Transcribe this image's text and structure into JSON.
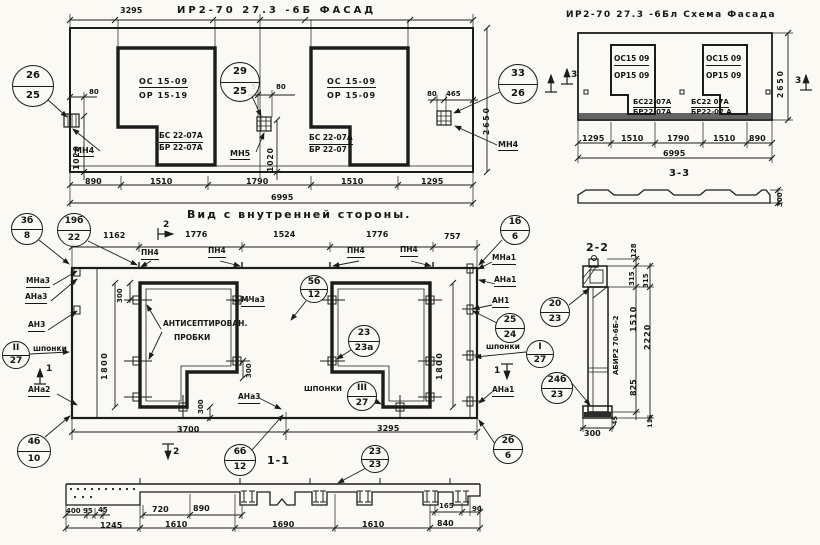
{
  "colors": {
    "ink": "#1c1c1c",
    "paper": "#faf9f4"
  },
  "labels": [
    {
      "name": "facade-title",
      "text": "ИР2-70 27.3 -6Б  ФАСАД",
      "x": 177,
      "y": 5,
      "fs": 10,
      "ls": 3
    },
    {
      "name": "schema-title",
      "text": "ИР2-70 27.3 -6Бл  Схема Фасада",
      "x": 566,
      "y": 10,
      "fs": 9,
      "ls": 1.5
    },
    {
      "name": "inner-view-title",
      "text": "Вид с внутренней стороны.",
      "x": 187,
      "y": 209,
      "fs": 11,
      "ls": 2
    },
    {
      "name": "section-1-1-title",
      "text": "1-1",
      "x": 267,
      "y": 455,
      "fs": 11,
      "ls": 1
    },
    {
      "name": "section-2-2-title",
      "text": "2-2",
      "x": 586,
      "y": 242,
      "fs": 11,
      "ls": 1
    },
    {
      "name": "section-3-3-title",
      "text": "3-3",
      "x": 669,
      "y": 168,
      "fs": 10,
      "ls": 1
    },
    {
      "name": "facade-dim-3295",
      "text": "3295",
      "x": 120,
      "y": 6
    },
    {
      "name": "facade-dim-890",
      "text": "890",
      "x": 85,
      "y": 177
    },
    {
      "name": "facade-dim-1510-a",
      "text": "1510",
      "x": 150,
      "y": 177
    },
    {
      "name": "facade-dim-1790",
      "text": "1790",
      "x": 246,
      "y": 177
    },
    {
      "name": "facade-dim-1510-b",
      "text": "1510",
      "x": 341,
      "y": 177
    },
    {
      "name": "facade-dim-1295",
      "text": "1295",
      "x": 421,
      "y": 177
    },
    {
      "name": "facade-dim-6995",
      "text": "6995",
      "x": 271,
      "y": 193
    },
    {
      "name": "facade-dim-80-left",
      "text": "80",
      "x": 89,
      "y": 88,
      "fs": 7
    },
    {
      "name": "facade-dim-1020-left",
      "text": "1020",
      "x": 73,
      "y": 170,
      "rot": -90,
      "fs": 7.5,
      "ls": 1
    },
    {
      "name": "facade-anchor-mn4-left",
      "text": "МН4",
      "x": 74,
      "y": 146,
      "u": 1
    },
    {
      "name": "facade-dim-5",
      "text": "5",
      "x": 251,
      "y": 83,
      "fs": 7
    },
    {
      "name": "facade-dim-80-mid",
      "text": "80",
      "x": 276,
      "y": 83,
      "fs": 7
    },
    {
      "name": "facade-dim-1020-mid",
      "text": "1020",
      "x": 267,
      "y": 172,
      "rot": -90,
      "fs": 7.5,
      "ls": 1
    },
    {
      "name": "facade-anchor-mn5",
      "text": "МН5",
      "x": 230,
      "y": 149,
      "u": 1
    },
    {
      "name": "facade-dim-80-right",
      "text": "80",
      "x": 427,
      "y": 90,
      "fs": 7
    },
    {
      "name": "facade-dim-465",
      "text": "465",
      "x": 446,
      "y": 90,
      "fs": 7
    },
    {
      "name": "facade-dim-2650",
      "text": "2650",
      "x": 483,
      "y": 135,
      "rot": -90,
      "fs": 7.5,
      "ls": 2
    },
    {
      "name": "facade-anchor-mn4-right",
      "text": "МН4",
      "x": 498,
      "y": 140,
      "u": 1
    },
    {
      "name": "facade-win1-block-os",
      "text": "ОС 15-09",
      "x": 139,
      "y": 77,
      "u": 1,
      "ls": 1
    },
    {
      "name": "facade-win1-block-or",
      "text": "ОР 15-19",
      "x": 139,
      "y": 91,
      "ls": 1
    },
    {
      "name": "facade-win1-block-bs",
      "text": "БС 22-07А",
      "x": 159,
      "y": 132,
      "u": 1,
      "fs": 7.5
    },
    {
      "name": "facade-win1-block-br",
      "text": "БР 22-07А",
      "x": 159,
      "y": 144,
      "fs": 7.5
    },
    {
      "name": "facade-win2-block-os",
      "text": "ОС 15-09",
      "x": 327,
      "y": 77,
      "u": 1,
      "ls": 1
    },
    {
      "name": "facade-win2-block-or",
      "text": "ОР 15-09",
      "x": 327,
      "y": 91,
      "ls": 1
    },
    {
      "name": "facade-win2-block-bs",
      "text": "БС 22-07А",
      "x": 309,
      "y": 134,
      "u": 1,
      "fs": 7.5
    },
    {
      "name": "facade-win2-block-br",
      "text": "БР 22-07",
      "x": 309,
      "y": 146,
      "fs": 7.5
    },
    {
      "name": "schema-win1-block-os",
      "text": "ОС15 09",
      "x": 614,
      "y": 55,
      "u": 1,
      "fs": 7.5
    },
    {
      "name": "schema-win1-block-or",
      "text": "ОР15 09",
      "x": 614,
      "y": 72,
      "fs": 7.5
    },
    {
      "name": "schema-win1-block-bs",
      "text": "БС22-07А",
      "x": 633,
      "y": 98,
      "u": 1,
      "fs": 7
    },
    {
      "name": "schema-win1-block-br",
      "text": "БР22-07А",
      "x": 633,
      "y": 108,
      "fs": 7
    },
    {
      "name": "schema-win2-block-os",
      "text": "ОС15 09",
      "x": 706,
      "y": 55,
      "u": 1,
      "fs": 7.5
    },
    {
      "name": "schema-win2-block-or",
      "text": "ОР15 09",
      "x": 706,
      "y": 72,
      "fs": 7.5
    },
    {
      "name": "schema-win2-block-bs",
      "text": "БС22 07А",
      "x": 691,
      "y": 98,
      "u": 1,
      "fs": 7
    },
    {
      "name": "schema-win2-block-br",
      "text": "БР22-07 А",
      "x": 691,
      "y": 108,
      "fs": 7
    },
    {
      "name": "schema-dim-1295",
      "text": "1295",
      "x": 582,
      "y": 134
    },
    {
      "name": "schema-dim-1510-a",
      "text": "1510",
      "x": 621,
      "y": 134
    },
    {
      "name": "schema-dim-1790",
      "text": "1790",
      "x": 667,
      "y": 134
    },
    {
      "name": "schema-dim-1510-b",
      "text": "1510",
      "x": 713,
      "y": 134
    },
    {
      "name": "schema-dim-890",
      "text": "890",
      "x": 749,
      "y": 134
    },
    {
      "name": "schema-dim-6995",
      "text": "6995",
      "x": 663,
      "y": 149
    },
    {
      "name": "schema-dim-2650",
      "text": "2650",
      "x": 777,
      "y": 98,
      "rot": -90,
      "fs": 7.5,
      "ls": 2
    },
    {
      "name": "schema-section3-left",
      "text": "3",
      "x": 571,
      "y": 70,
      "fs": 9
    },
    {
      "name": "schema-section3-right",
      "text": "3",
      "x": 795,
      "y": 76,
      "fs": 9
    },
    {
      "name": "section33-dim-300",
      "text": "300",
      "x": 776,
      "y": 207,
      "rot": -90,
      "fs": 7
    },
    {
      "name": "inner-dim-1162",
      "text": "1162",
      "x": 103,
      "y": 231
    },
    {
      "name": "inner-dim-1776-a",
      "text": "1776",
      "x": 185,
      "y": 230
    },
    {
      "name": "inner-dim-1524",
      "text": "1524",
      "x": 273,
      "y": 230
    },
    {
      "name": "inner-dim-1776-b",
      "text": "1776",
      "x": 366,
      "y": 230
    },
    {
      "name": "inner-dim-757",
      "text": "757",
      "x": 444,
      "y": 232
    },
    {
      "name": "inner-section2-top",
      "text": "2",
      "x": 163,
      "y": 220,
      "fs": 9
    },
    {
      "name": "inner-pn4-1",
      "text": "ПН4",
      "x": 141,
      "y": 249,
      "u": 1,
      "fs": 7.5
    },
    {
      "name": "inner-pn4-2",
      "text": "ПН4",
      "x": 208,
      "y": 247,
      "u": 1,
      "fs": 7.5
    },
    {
      "name": "inner-pn4-3",
      "text": "ПН4",
      "x": 347,
      "y": 247,
      "u": 1,
      "fs": 7.5
    },
    {
      "name": "inner-pn4-4",
      "text": "ПН4",
      "x": 400,
      "y": 246,
      "u": 1,
      "fs": 7.5
    },
    {
      "name": "inner-anchor-mna3",
      "text": "МНа3",
      "x": 26,
      "y": 277,
      "u": 1,
      "fs": 7.5
    },
    {
      "name": "inner-anchor-ana3",
      "text": "АНа3",
      "x": 25,
      "y": 293,
      "u": 1,
      "fs": 7.5
    },
    {
      "name": "inner-anchor-an3",
      "text": "АН3",
      "x": 28,
      "y": 321,
      "u": 1,
      "fs": 7.5
    },
    {
      "name": "inner-shponki-left",
      "text": "шпонки",
      "x": 33,
      "y": 345,
      "fs": 7.5
    },
    {
      "name": "inner-section1-left",
      "text": "1",
      "x": 46,
      "y": 364,
      "fs": 9
    },
    {
      "name": "inner-anchor-ana2",
      "text": "АНа2",
      "x": 28,
      "y": 386,
      "u": 1,
      "fs": 7.5
    },
    {
      "name": "inner-dim-300-a",
      "text": "300",
      "x": 116,
      "y": 303,
      "rot": -90,
      "fs": 7
    },
    {
      "name": "inner-dim-1800-left",
      "text": "1800",
      "x": 100,
      "y": 380,
      "rot": -90,
      "fs": 8,
      "ls": 1.5
    },
    {
      "name": "inner-note-antiseptic-1",
      "text": "АНТИСЕПТИРОВАН.",
      "x": 163,
      "y": 320,
      "fs": 7.5
    },
    {
      "name": "inner-note-antiseptic-2",
      "text": "ПРОБКИ",
      "x": 174,
      "y": 334,
      "fs": 7.5
    },
    {
      "name": "inner-anchor-mcha3",
      "text": "МЧа3",
      "x": 241,
      "y": 296,
      "u": 1,
      "fs": 7.5
    },
    {
      "name": "inner-dim-300-b",
      "text": "300",
      "x": 245,
      "y": 378,
      "rot": -90,
      "fs": 7
    },
    {
      "name": "inner-dim-300-c",
      "text": "300",
      "x": 197,
      "y": 414,
      "rot": -90,
      "fs": 7
    },
    {
      "name": "inner-shponki-mid",
      "text": "ШПОНКИ",
      "x": 304,
      "y": 385,
      "fs": 7
    },
    {
      "name": "inner-anchor-ana3-bottom",
      "text": "АНа3",
      "x": 238,
      "y": 393,
      "u": 1,
      "fs": 7.5
    },
    {
      "name": "inner-dim-1800-right",
      "text": "1800",
      "x": 435,
      "y": 380,
      "rot": -90,
      "fs": 8,
      "ls": 1.5
    },
    {
      "name": "inner-anchor-mna1",
      "text": "МНа1",
      "x": 492,
      "y": 254,
      "u": 1,
      "fs": 7.5
    },
    {
      "name": "inner-anchor-ana1",
      "text": "АНа1",
      "x": 494,
      "y": 276,
      "u": 1,
      "fs": 7.5
    },
    {
      "name": "inner-anchor-an1",
      "text": "АН1",
      "x": 492,
      "y": 297,
      "u": 1,
      "fs": 7.5
    },
    {
      "name": "inner-shponki-right",
      "text": "шпонки",
      "x": 486,
      "y": 343,
      "fs": 7.5
    },
    {
      "name": "inner-section1-right",
      "text": "1",
      "x": 494,
      "y": 366,
      "fs": 9
    },
    {
      "name": "inner-anchor-ana1-bottom",
      "text": "АНа1",
      "x": 492,
      "y": 386,
      "u": 1,
      "fs": 7.5
    },
    {
      "name": "inner-dim-3700",
      "text": "3700",
      "x": 177,
      "y": 425
    },
    {
      "name": "inner-dim-3295",
      "text": "3295",
      "x": 377,
      "y": 424
    },
    {
      "name": "inner-section2-bottom",
      "text": "2",
      "x": 173,
      "y": 447,
      "fs": 9
    },
    {
      "name": "sec11-dim-400",
      "text": "400",
      "x": 66,
      "y": 507,
      "fs": 7
    },
    {
      "name": "sec11-dim-95",
      "text": "95",
      "x": 83,
      "y": 507,
      "fs": 7
    },
    {
      "name": "sec11-dim-45",
      "text": "45",
      "x": 98,
      "y": 506,
      "fs": 7
    },
    {
      "name": "sec11-dim-720",
      "text": "720",
      "x": 152,
      "y": 505
    },
    {
      "name": "sec11-dim-890",
      "text": "890",
      "x": 193,
      "y": 504
    },
    {
      "name": "sec11-dim-165",
      "text": "165",
      "x": 439,
      "y": 502,
      "fs": 7
    },
    {
      "name": "sec11-dim-90",
      "text": "90",
      "x": 472,
      "y": 505,
      "fs": 7
    },
    {
      "name": "sec11-dim-1245",
      "text": "1245",
      "x": 100,
      "y": 521
    },
    {
      "name": "sec11-dim-1610-a",
      "text": "1610",
      "x": 165,
      "y": 520
    },
    {
      "name": "sec11-dim-1690",
      "text": "1690",
      "x": 272,
      "y": 520
    },
    {
      "name": "sec11-dim-1610-b",
      "text": "1610",
      "x": 362,
      "y": 520
    },
    {
      "name": "sec11-dim-840",
      "text": "840",
      "x": 437,
      "y": 519
    },
    {
      "name": "sec22-dim-128",
      "text": "128",
      "x": 630,
      "y": 258,
      "rot": -90,
      "fs": 7
    },
    {
      "name": "sec22-dim-315-a",
      "text": "315",
      "x": 628,
      "y": 286,
      "rot": -90,
      "fs": 7
    },
    {
      "name": "sec22-dim-315-b",
      "text": "315",
      "x": 642,
      "y": 288,
      "rot": -90,
      "fs": 7
    },
    {
      "name": "sec22-dim-1510",
      "text": "1510",
      "x": 629,
      "y": 332,
      "rot": -90,
      "fs": 8,
      "ls": 1
    },
    {
      "name": "sec22-dim-2220",
      "text": "2220",
      "x": 643,
      "y": 350,
      "rot": -90,
      "fs": 8,
      "ls": 1
    },
    {
      "name": "sec22-dim-825",
      "text": "825",
      "x": 629,
      "y": 396,
      "rot": -90,
      "fs": 8
    },
    {
      "name": "sec22-dim-45",
      "text": "45",
      "x": 612,
      "y": 425,
      "rot": -90,
      "fs": 6.5
    },
    {
      "name": "sec22-dim-115",
      "text": "115",
      "x": 647,
      "y": 428,
      "rot": -90,
      "fs": 6.5
    },
    {
      "name": "sec22-dim-300",
      "text": "300",
      "x": 584,
      "y": 429,
      "fs": 8
    },
    {
      "name": "sec22-stamp",
      "text": "АБИР2 70-6Б-2",
      "x": 612,
      "y": 375,
      "rot": -90,
      "fs": 7
    }
  ],
  "callouts": [
    {
      "name": "callout-26-25",
      "top": "26",
      "bot": "25",
      "cx": 33,
      "cy": 86,
      "r": 21,
      "fs": 10
    },
    {
      "name": "callout-29-25",
      "top": "29",
      "bot": "25",
      "cx": 240,
      "cy": 82,
      "r": 20,
      "fs": 10
    },
    {
      "name": "callout-33-26",
      "top": "33",
      "bot": "26",
      "cx": 518,
      "cy": 84,
      "r": 20,
      "fs": 10
    },
    {
      "name": "callout-3b-8",
      "top": "3б",
      "bot": "8",
      "cx": 27,
      "cy": 229,
      "r": 16
    },
    {
      "name": "callout-19b-22",
      "top": "19б",
      "bot": "22",
      "cx": 74,
      "cy": 230,
      "r": 17
    },
    {
      "name": "callout-1b-6",
      "top": "1б",
      "bot": "6",
      "cx": 515,
      "cy": 230,
      "r": 15
    },
    {
      "name": "callout-5b-12",
      "top": "5б",
      "bot": "12",
      "cx": 314,
      "cy": 289,
      "r": 14
    },
    {
      "name": "callout-23-23a",
      "top": "23",
      "bot": "23а",
      "cx": 364,
      "cy": 341,
      "r": 16
    },
    {
      "name": "callout-II-27",
      "top": "II",
      "bot": "27",
      "cx": 16,
      "cy": 355,
      "r": 14
    },
    {
      "name": "callout-I-27",
      "top": "I",
      "bot": "27",
      "cx": 540,
      "cy": 354,
      "r": 14
    },
    {
      "name": "callout-III-27",
      "top": "III",
      "bot": "27",
      "cx": 362,
      "cy": 396,
      "r": 15
    },
    {
      "name": "callout-25-24",
      "top": "25",
      "bot": "24",
      "cx": 510,
      "cy": 328,
      "r": 15
    },
    {
      "name": "callout-4b-10",
      "top": "4б",
      "bot": "10",
      "cx": 34,
      "cy": 451,
      "r": 17
    },
    {
      "name": "callout-6b-12",
      "top": "6б",
      "bot": "12",
      "cx": 240,
      "cy": 460,
      "r": 16
    },
    {
      "name": "callout-23-23",
      "top": "23",
      "bot": "23",
      "cx": 375,
      "cy": 459,
      "r": 14
    },
    {
      "name": "callout-2b-6",
      "top": "2б",
      "bot": "6",
      "cx": 508,
      "cy": 449,
      "r": 15
    },
    {
      "name": "callout-20-23",
      "top": "20",
      "bot": "23",
      "cx": 555,
      "cy": 312,
      "r": 15
    },
    {
      "name": "callout-24b-23",
      "top": "24б",
      "bot": "23",
      "cx": 557,
      "cy": 388,
      "r": 16
    }
  ]
}
